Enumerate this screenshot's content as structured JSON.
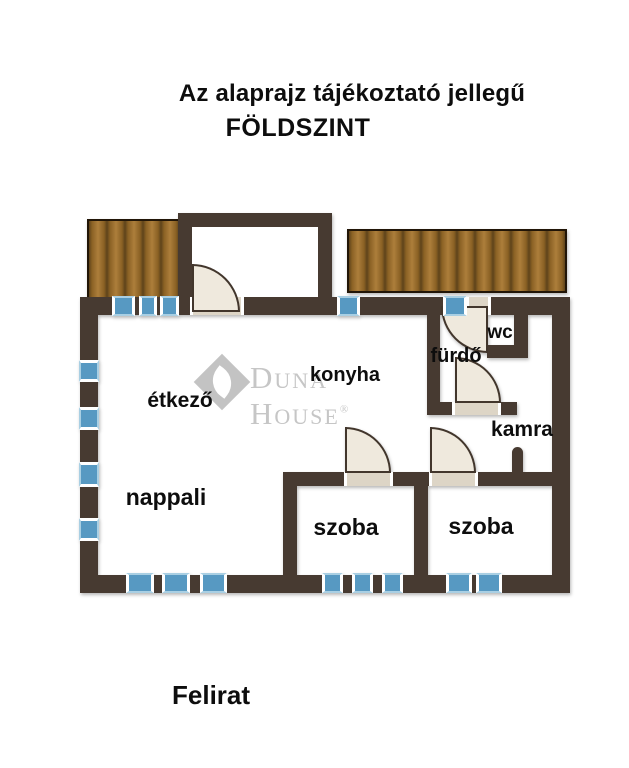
{
  "header": {
    "disclaimer": "Az alaprajz tájékoztató jellegű",
    "floor": "FÖLDSZINT"
  },
  "footer": {
    "caption": "Felirat"
  },
  "watermark": {
    "brand": "Duna House",
    "registered": "®"
  },
  "rooms": {
    "etkezo": "étkező",
    "konyha": "konyha",
    "nappali": "nappali",
    "szoba1": "szoba",
    "szoba2": "szoba",
    "furdo": "fürdő",
    "wc": "wc",
    "kamra": "kamra"
  },
  "colors": {
    "wall": "#473a31",
    "window": "#5799c2",
    "door": "#efe9dd",
    "deck": "#8a6124",
    "watermark_gray": "#c6c6c6"
  }
}
